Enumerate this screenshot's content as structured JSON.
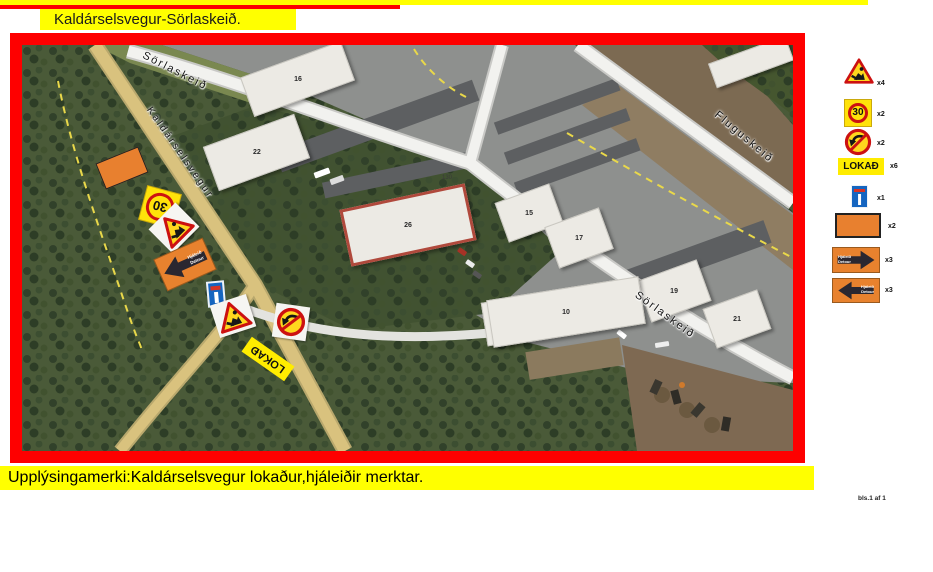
{
  "header": {
    "title": "Kaldárselsvegur-Sörlaskeið."
  },
  "footer": {
    "info": "Upplýsingamerki:Kaldárselsvegur lokaður,hjáleiðir merktar.",
    "page_indicator": "bls.1 af 1"
  },
  "legend": {
    "items": [
      {
        "name": "roadwork-warning",
        "count": "x4"
      },
      {
        "name": "speed-limit-30",
        "label": "30",
        "count": "x2"
      },
      {
        "name": "no-left-turn",
        "count": "x2"
      },
      {
        "name": "road-closed",
        "label": "LOKAÐ",
        "count": "x6"
      },
      {
        "name": "dead-end",
        "count": "x1"
      },
      {
        "name": "work-area-marker",
        "count": "x2"
      },
      {
        "name": "detour-arrow-right",
        "line1": "Hjáleið",
        "line2": "Detour",
        "count": "x3"
      },
      {
        "name": "detour-arrow-left",
        "line1": "Hjáleið",
        "line2": "Detour",
        "count": "x3"
      }
    ]
  },
  "map": {
    "road_labels": {
      "kaldarselsvegur": "Kaldárselsvegur",
      "sorlaskeid_top": "Sörlaskeið",
      "fluguskeid": "Fluguskeið",
      "sorlaskeid_lower": "Sörlaskeið"
    },
    "buildings": [
      {
        "label": "16"
      },
      {
        "label": "22"
      },
      {
        "label": "26"
      },
      {
        "label": "15"
      },
      {
        "label": "17"
      },
      {
        "label": "19"
      },
      {
        "label": "21"
      },
      {
        "label": "10"
      }
    ],
    "lot_number": "130",
    "signs": {
      "speed_limit": "30",
      "closed": "LOKAÐ",
      "detour_line1": "Hjáleið",
      "detour_line2": "Detour"
    }
  },
  "colors": {
    "highlight_yellow": "#ffff00",
    "frame_red": "#fe0000",
    "sign_orange": "#e8822e",
    "sign_yellow": "#ffd71e",
    "sign_red": "#cc1111",
    "deadend_blue": "#1565c0"
  }
}
